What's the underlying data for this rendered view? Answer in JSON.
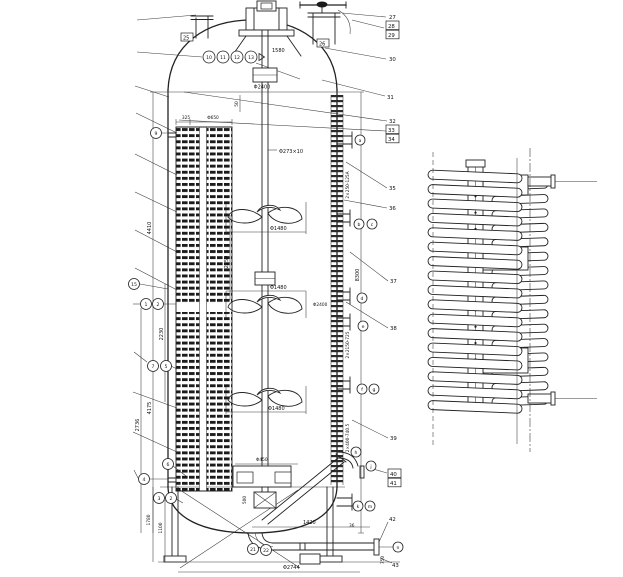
{
  "colors": {
    "ink": "#222222",
    "paper": "#ffffff"
  },
  "dims": {
    "phi2400_top": "Φ2400",
    "phi2400_mid": "Φ2400",
    "shaft_spec": "Φ273×10",
    "d1580": "1580",
    "d50": "50",
    "d325": "325",
    "phi650": "Φ650",
    "d4410": "4410",
    "d2230": "2230",
    "d4175": "4175",
    "d2736": "2736",
    "d2250": "2250",
    "d8300": "8300",
    "phi1480_1": "Φ1480",
    "phi1480_2": "Φ1480",
    "phi1480_3": "Φ1480",
    "phi450": "Φ450",
    "d500": "500",
    "d1420": "1420",
    "phi2744": "Φ2744",
    "d750": "750",
    "d36": "36",
    "d1780": "1780",
    "d1100": "1100",
    "jacket_spec_1": "2×250-125A",
    "jacket_spec_2": "2×2150-725",
    "jacket_spec_3": "2×400-740.5"
  },
  "balloons": {
    "head_row": [
      "10",
      "11",
      "12",
      "13"
    ],
    "left": {
      "b9": "9",
      "b15": "15",
      "b1": "1",
      "b2": "2",
      "b7": "7",
      "b5": "5",
      "b6": "6",
      "b4": "4",
      "b3": "3",
      "b2b": "2"
    },
    "bottom": {
      "b21": "21",
      "b22": "22"
    },
    "nozzles": {
      "a": "a",
      "b": "b",
      "c": "c",
      "d": "d",
      "e": "e",
      "f": "f",
      "g": "g",
      "h": "h",
      "j": "j",
      "k": "k",
      "m": "m",
      "n": "n"
    }
  },
  "flags": {
    "f25": "25",
    "f26": "26"
  },
  "parts": {
    "p27": "27",
    "p28": "28",
    "p29": "29",
    "p30": "30",
    "p31": "31",
    "p32": "32",
    "p33": "33",
    "p34": "34",
    "p35": "35",
    "p36": "36",
    "p37": "37",
    "p38": "38",
    "p39": "39",
    "p40": "40",
    "p41": "41",
    "p42": "42",
    "p43": "43"
  }
}
